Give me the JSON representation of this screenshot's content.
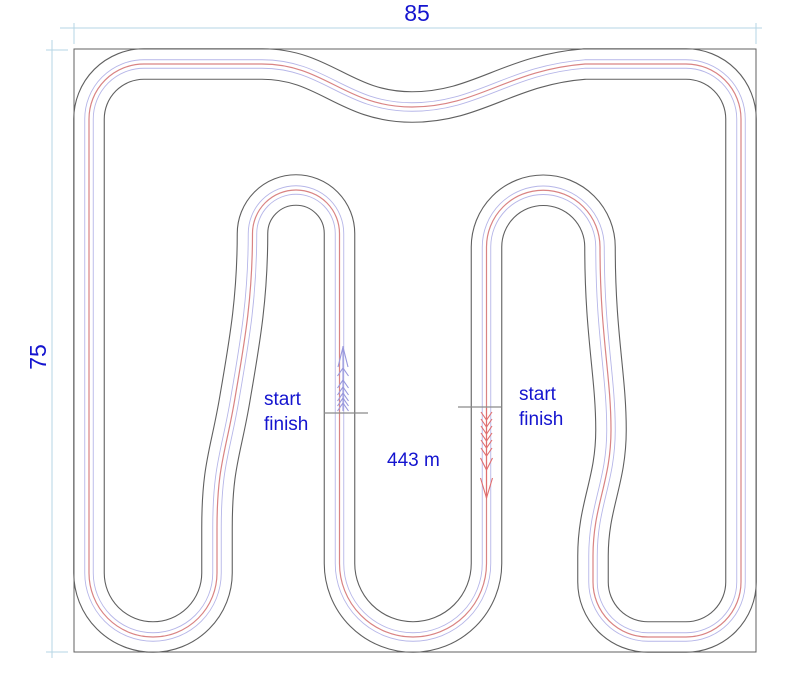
{
  "drawing": {
    "width_dimension": "85",
    "height_dimension": "75",
    "track_length": "443 m",
    "start_finish": {
      "line1": "start",
      "line2": "finish"
    },
    "left_direction": "up",
    "right_direction": "down"
  },
  "colors": {
    "label_text": "#1414cf",
    "dimension_line": "#b5d6e4",
    "track_edge": "#606060",
    "racing_line_red": "#d98383",
    "racing_line_blue": "#b6b6e8",
    "arrow_red": "#e06e6e",
    "arrow_blue": "#9898dd",
    "start_finish_line": "#8a8a8a",
    "background": "#ffffff"
  }
}
